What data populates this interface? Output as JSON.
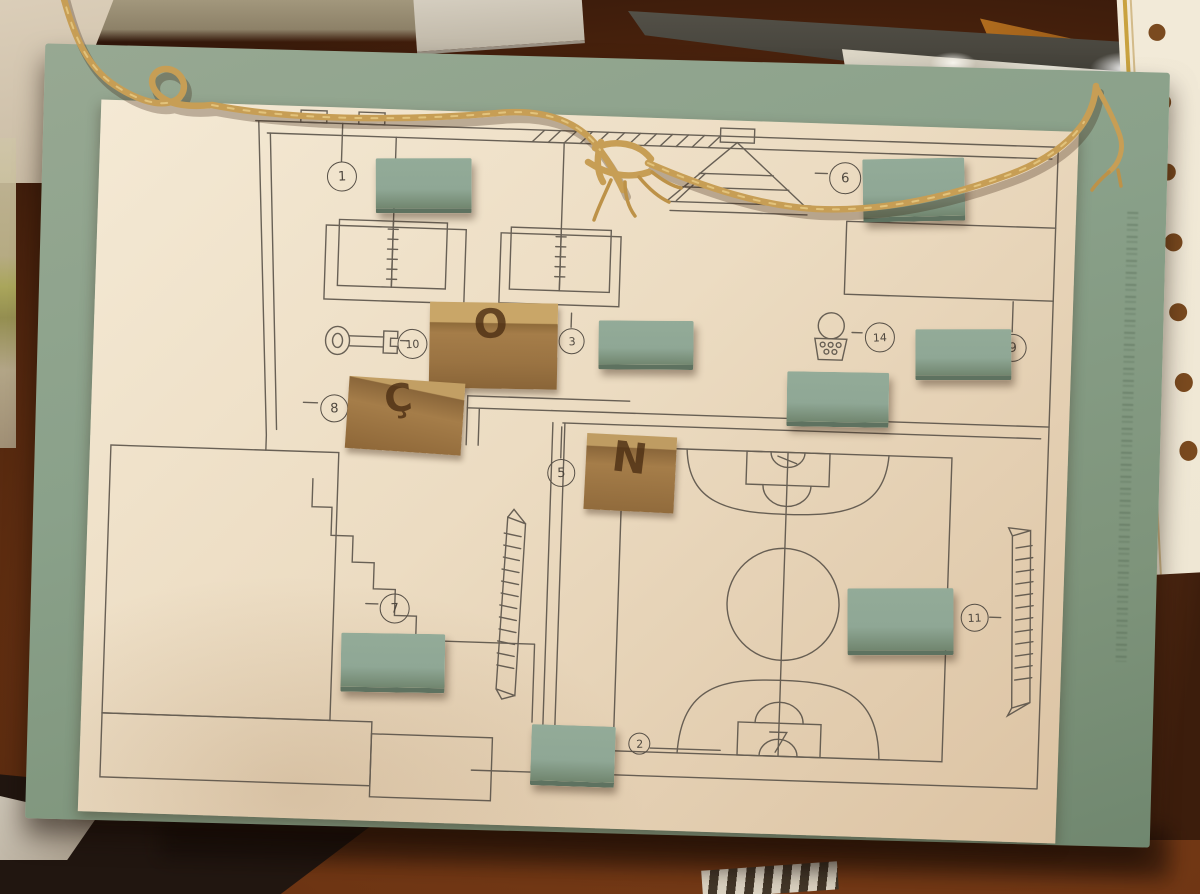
{
  "photo": {
    "description": "Hand-drawn school floor-plan map on white paper mounted on a sage-green board hung with twine; numbered circle markers, green felt cover blocks, and lifted kraft-paper flaps with handwritten letters"
  },
  "markers": [
    {
      "number": "1"
    },
    {
      "number": "6"
    },
    {
      "number": "3"
    },
    {
      "number": "14"
    },
    {
      "number": "9"
    },
    {
      "number": "10"
    },
    {
      "number": "8"
    },
    {
      "number": "5"
    },
    {
      "number": "7"
    },
    {
      "number": "11"
    },
    {
      "number": "2"
    }
  ],
  "flaps": [
    {
      "letter": "O"
    },
    {
      "letter": "Ç"
    },
    {
      "letter": "N"
    }
  ],
  "icons": [
    "key-icon",
    "open-book-tables",
    "stepped-pyramid-icon",
    "ball-basket-icon",
    "basketball-court",
    "bench-icon",
    "twine-string",
    "felt-cover",
    "kraft-flap",
    "perforated-paper-strip",
    "faint-edge-text"
  ],
  "colors": {
    "board": "#8aa18a",
    "felt": "#8fa795",
    "paper": "#ecdcc2",
    "ink": "#564f46",
    "kraft": "#a57d49",
    "letter": "#4e3014",
    "rope": "#c79e55",
    "table": "#7a3d18",
    "dark_paper": "#56534a",
    "orange_wood": "#b06c1e",
    "strip_paper": "#efe7d4",
    "strip_holes": "#7a4a1f"
  }
}
